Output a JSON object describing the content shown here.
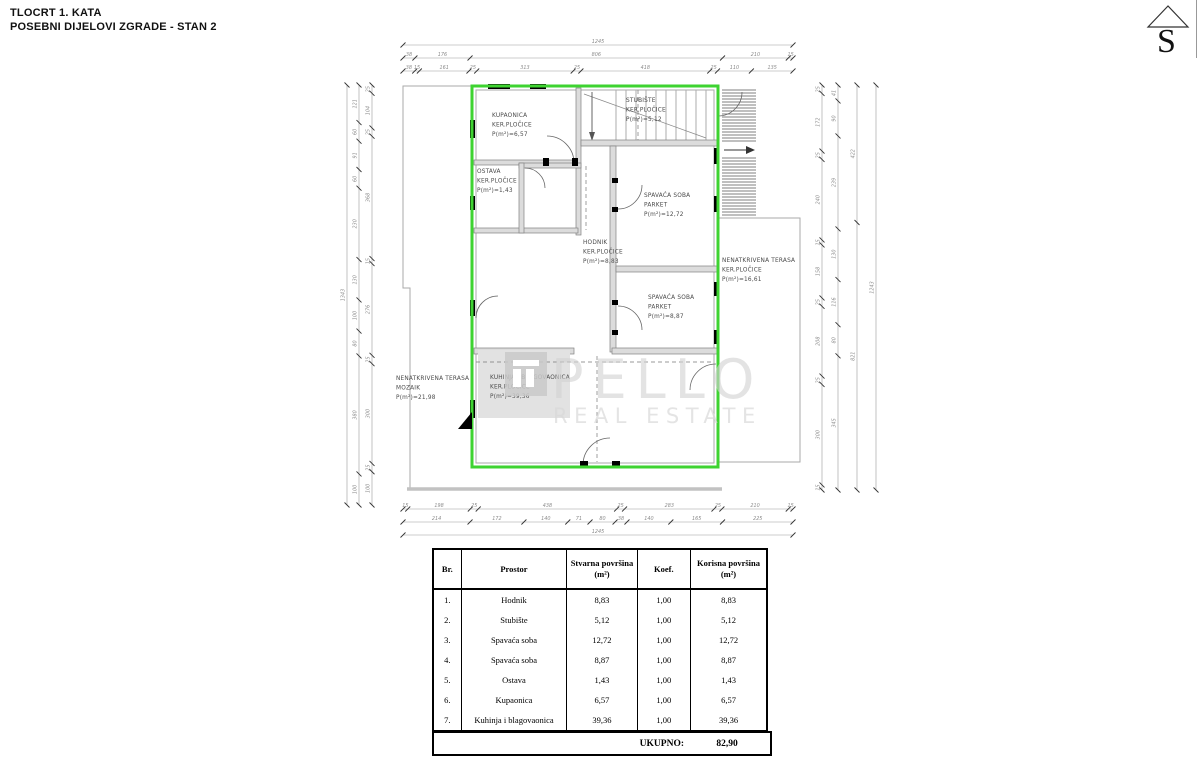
{
  "header": {
    "line1": "TLOCRT 1. KATA",
    "line2": "POSEBNI DIJELOVI ZGRADE - STAN 2"
  },
  "compass": {
    "letter": "S"
  },
  "watermark": {
    "brand": "PELLO",
    "sub": "REAL ESTATE"
  },
  "colors": {
    "unit_outline": "#3ed331",
    "wall_fill": "#dcdcdc",
    "watermark_gray": "#d2d2d2"
  },
  "plan": {
    "rooms": [
      {
        "id": "kupaonica",
        "lines": [
          "KUPAONICA",
          "KER.PLOČICE",
          "P(m²)=6,57"
        ]
      },
      {
        "id": "stubiste",
        "lines": [
          "STUBIŠTE",
          "KER.PLOČICE",
          "P(m²)=5,12"
        ]
      },
      {
        "id": "ostava",
        "lines": [
          "OSTAVA",
          "KER.PLOČICE",
          "P(m²)=1,43"
        ]
      },
      {
        "id": "spavaca-soba-1",
        "lines": [
          "SPAVAĆA SOBA",
          "PARKET",
          "P(m²)=12,72"
        ]
      },
      {
        "id": "hodnik",
        "lines": [
          "HODNIK",
          "KER.PLOČICE",
          "P(m²)=8,83"
        ]
      },
      {
        "id": "spavaca-soba-2",
        "lines": [
          "SPAVAĆA SOBA",
          "PARKET",
          "P(m²)=8,87"
        ]
      },
      {
        "id": "kuhinja",
        "lines": [
          "KUHINJA I BLAGOVAONICA",
          "KER.PLOČICE",
          "P(m²)=39,36"
        ]
      },
      {
        "id": "terasa-desno",
        "lines": [
          "NENATKRIVENA TERASA",
          "KER.PLOČICE",
          "P(m²)=16,61"
        ]
      },
      {
        "id": "terasa-lijevo",
        "lines": [
          "NENATKRIVENA TERASA",
          "MOZAIK",
          "P(m²)=21,98"
        ]
      }
    ]
  },
  "dimensions": {
    "top": [
      [
        "1245"
      ],
      [
        "38",
        "176",
        "806",
        "210",
        "15"
      ],
      [
        "38",
        "15",
        "161",
        "25",
        "313",
        "25",
        "418",
        "25",
        "110",
        "135"
      ]
    ],
    "bottom": [
      [
        "15",
        "198",
        "25",
        "438",
        "25",
        "283",
        "25",
        "210",
        "15"
      ],
      [
        "214",
        "172",
        "140",
        "71",
        "80",
        "38",
        "140",
        "165",
        "225"
      ],
      [
        "1245"
      ]
    ],
    "left": [
      [
        "1343"
      ],
      [
        "121",
        "60",
        "91",
        "60",
        "230",
        "130",
        "100",
        "80",
        "380",
        "100"
      ],
      [
        "25",
        "104",
        "25",
        "368",
        "15",
        "276",
        "25",
        "300",
        "25",
        "100"
      ]
    ],
    "right": [
      [
        "25",
        "172",
        "25",
        "240",
        "15",
        "158",
        "25",
        "208",
        "25",
        "300",
        "15"
      ],
      [
        "41",
        "90",
        "239",
        "130",
        "116",
        "80",
        "345"
      ],
      [
        "422",
        "821"
      ],
      [
        "1243"
      ]
    ]
  },
  "table": {
    "headers": [
      "Br.",
      "Prostor",
      "Stvarna površina (m²)",
      "Koef.",
      "Korisna površina (m²)"
    ],
    "rows": [
      [
        "1.",
        "Hodnik",
        "8,83",
        "1,00",
        "8,83"
      ],
      [
        "2.",
        "Stubište",
        "5,12",
        "1,00",
        "5,12"
      ],
      [
        "3.",
        "Spavaća soba",
        "12,72",
        "1,00",
        "12,72"
      ],
      [
        "4.",
        "Spavaća soba",
        "8,87",
        "1,00",
        "8,87"
      ],
      [
        "5.",
        "Ostava",
        "1,43",
        "1,00",
        "1,43"
      ],
      [
        "6.",
        "Kupaonica",
        "6,57",
        "1,00",
        "6,57"
      ],
      [
        "7.",
        "Kuhinja i blagovaonica",
        "39,36",
        "1,00",
        "39,36"
      ]
    ],
    "total_label": "UKUPNO:",
    "total_value": "82,90"
  }
}
